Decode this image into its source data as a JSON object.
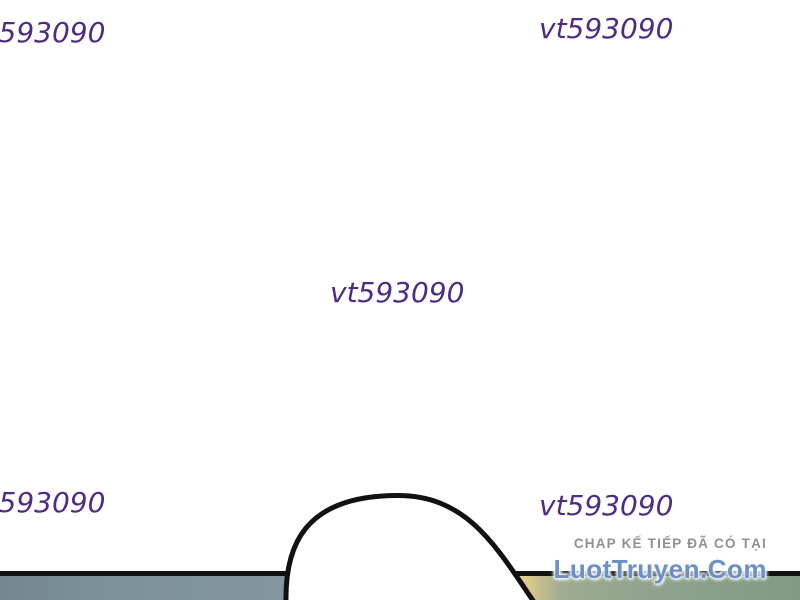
{
  "watermarks": {
    "color": "#4e2c84",
    "items": [
      {
        "position": "top-left",
        "text": "vt593090"
      },
      {
        "position": "top-right",
        "text": "vt593090"
      },
      {
        "position": "center",
        "text": "vt593090"
      },
      {
        "position": "bottom-left",
        "text": "vt593090"
      },
      {
        "position": "bottom-right",
        "text": "vt593090"
      }
    ]
  },
  "promo": {
    "heading": "CHAP KẾ TIẾP ĐÃ CÓ TẠI",
    "site": "LuotTruyen.Com"
  },
  "colors": {
    "wm-color": "#4e2c84",
    "heading-color": "#909090",
    "site-color": "#6b90c6",
    "outline-color": "#111111",
    "panel-left": "#7e929a",
    "panel-right": "#8ca18b",
    "panel-glow": "#eedfa8",
    "dome-fill": "#ffffff"
  }
}
